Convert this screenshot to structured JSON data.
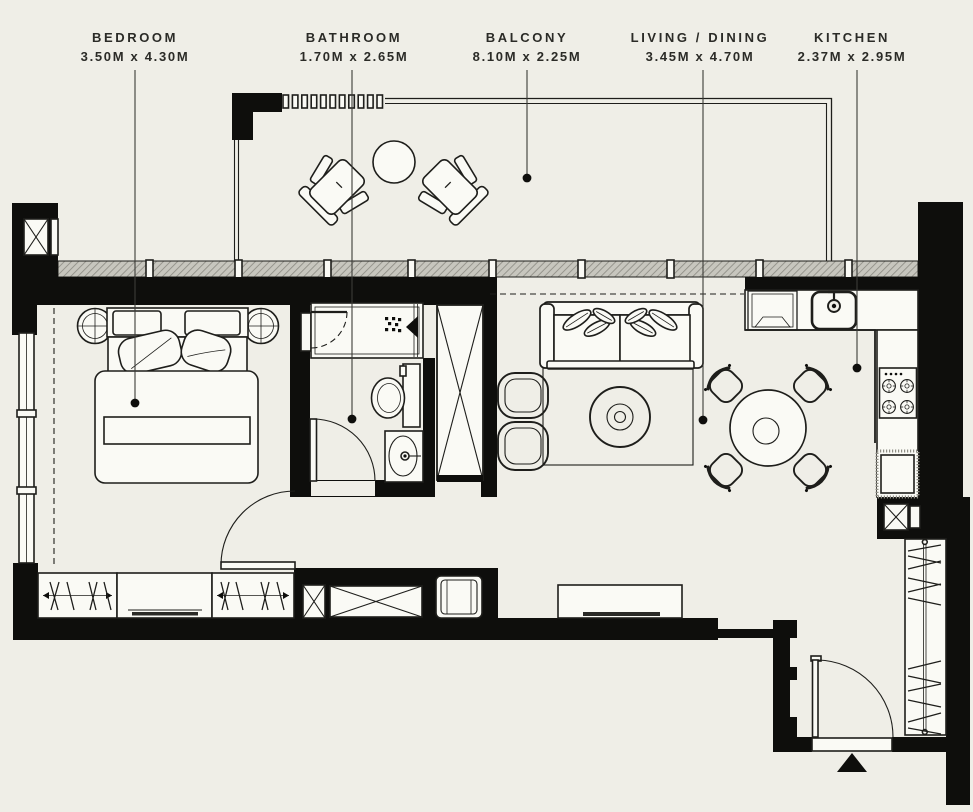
{
  "palette": {
    "background": "#efeee7",
    "wall": "#0e0e0c",
    "line": "#1e1e1b",
    "paper": "#fafaf5",
    "text": "#2b2b27",
    "leader": "#3c3c38",
    "hatch_base": "#c7c6be",
    "hatch_line": "#8e8d85"
  },
  "rooms": [
    {
      "id": "bedroom",
      "label": "BEDROOM",
      "dimensions": "3.50M x 4.30M"
    },
    {
      "id": "bathroom",
      "label": "BATHROOM",
      "dimensions": "1.70M x 2.65M"
    },
    {
      "id": "balcony",
      "label": "BALCONY",
      "dimensions": "8.10M x 2.25M"
    },
    {
      "id": "living-dining",
      "label": "LIVING / DINING",
      "dimensions": "3.45M x 4.70M"
    },
    {
      "id": "kitchen",
      "label": "KITCHEN",
      "dimensions": "2.37M x 2.95M"
    }
  ]
}
